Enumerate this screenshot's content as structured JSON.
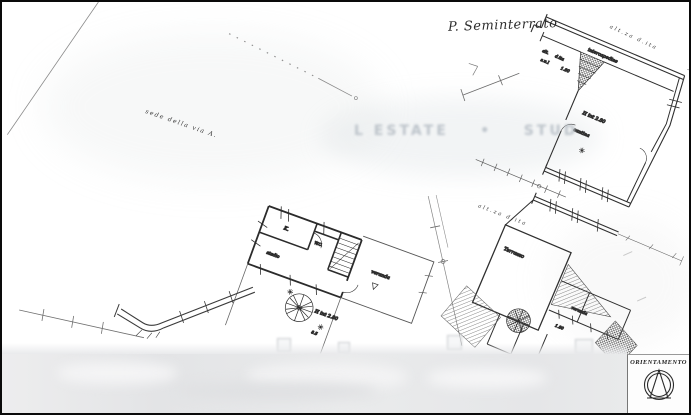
{
  "colors": {
    "paper": "#ffffff",
    "ink": "#2e2e2e",
    "ink_light": "#6a6a6a",
    "watermark": "#b9c0c7",
    "border": "#0a0a0a",
    "blur_strip": "#e6e7e9"
  },
  "header": {
    "floor_title": "P. Seminterrato"
  },
  "watermark": {
    "text": "L ESTATE    •    STUD"
  },
  "boundary": {
    "sede_via": "sede della via A."
  },
  "annotations": {
    "alt_top_right": "alt.za  d.ita",
    "alt_above_plan3": "alt.za  d.ita"
  },
  "plan1": {
    "intercapedine": "intercapedine",
    "alt_small": "alt.",
    "dita_small": "d.ita",
    "sul_small": "s.u.l",
    "dim_180": "1.80",
    "room_height": "H int 2.80",
    "room_label": "cantina"
  },
  "plan2": {
    "kitchen": "K.",
    "wc": "W.C.",
    "studio": "studio",
    "veranda": "veranda",
    "room_height": "H int 2.80",
    "dim": "8.5"
  },
  "plan3": {
    "terrace": "Terrazzo",
    "room": "veranda",
    "dim": "1.80"
  },
  "orientation": {
    "label": "ORIENTAMENTO"
  }
}
